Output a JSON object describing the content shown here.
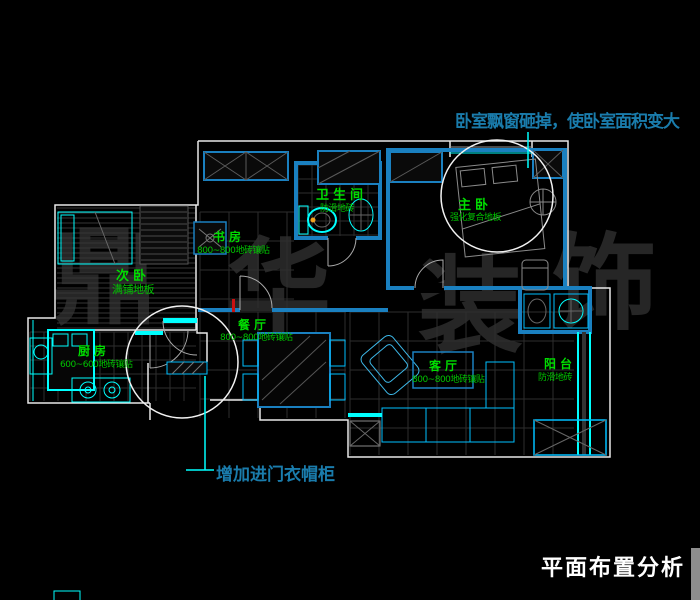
{
  "annotations": {
    "bay_window": "卧室飘窗砸掉，使卧室面积变大",
    "entry_closet": "增加进门衣帽柜",
    "title": "平面布置分析"
  },
  "watermark": {
    "char1": "鼎",
    "char2": "华",
    "char3": "装",
    "char4": "饰"
  },
  "rooms": {
    "bathroom": {
      "name": "卫生间",
      "note": "防滑地砖"
    },
    "study": {
      "name": "书房",
      "note": "800~800地砖镶贴"
    },
    "master": {
      "name": "主卧",
      "note": "强化复合地板"
    },
    "bedroom2": {
      "name": "次卧",
      "note": "满铺地板"
    },
    "kitchen": {
      "name": "厨房",
      "note": "600~600地砖镶贴"
    },
    "dining": {
      "name": "餐厅",
      "note": "800~800地砖镶贴"
    },
    "living": {
      "name": "客厅",
      "note": "800~800地砖镶贴"
    },
    "balcony": {
      "name": "阳台",
      "note": "防滑地砖"
    }
  },
  "colors": {
    "background": "#000000",
    "annotation_teal": "#1a7cac",
    "room_label_green": "#00dd00",
    "fixture_cyan": "#00ffff",
    "wall_blue": "#1a80c0",
    "wall_white": "#e8e8e8",
    "title_white": "#ffffff",
    "watermark_gray": "#262626",
    "highlight_red": "#cc1111",
    "tile_grid": "#2e2e2e"
  }
}
